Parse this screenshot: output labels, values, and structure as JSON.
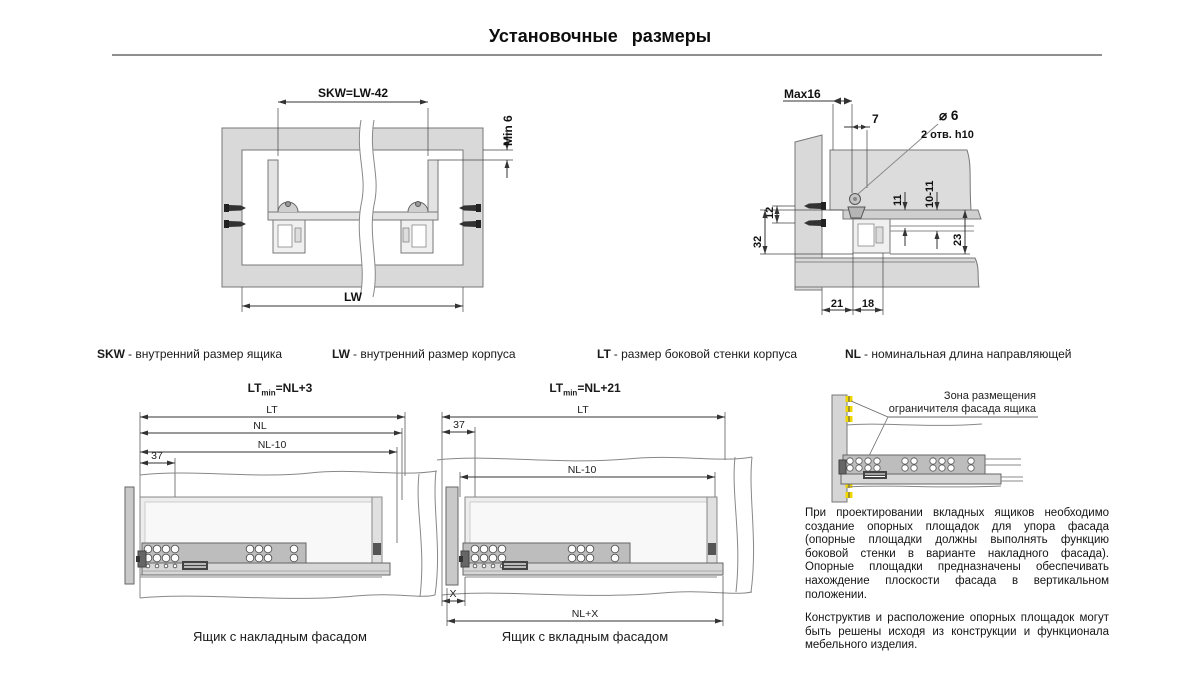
{
  "title": "Установочные размеры",
  "legend": [
    {
      "abbr": "SKW",
      "desc": "- внутренний размер ящика"
    },
    {
      "abbr": "LW",
      "desc": "- внутренний размер корпуса"
    },
    {
      "abbr": "LT",
      "desc": "- размер боковой стенки корпуса"
    },
    {
      "abbr": "NL",
      "desc": "- номинальная длина направляющей"
    }
  ],
  "top_left_drawing": {
    "skw": "SKW=LW-42",
    "min6": "Min 6",
    "lw": "LW"
  },
  "top_right_drawing": {
    "max16": "Max16",
    "seven": "7",
    "diameter": "⌀ 6",
    "holes": "2 отв. h10",
    "d12": "12",
    "d32": "32",
    "d11": "11",
    "d10_11": "10-11",
    "d23": "23",
    "d21": "21",
    "d18": "18"
  },
  "bottom_left_drawing": {
    "formula_base": "LT",
    "formula_sub": "min",
    "formula_rest": "=NL+3",
    "lt": "LT",
    "nl": "NL",
    "nl10": "NL-10",
    "d37": "37",
    "caption": "Ящик с накладным фасадом"
  },
  "bottom_middle_drawing": {
    "formula_base": "LT",
    "formula_sub": "min",
    "formula_rest": "=NL+21",
    "lt": "LT",
    "d37": "37",
    "nl10": "NL-10",
    "x": "X",
    "nlx": "NL+X",
    "caption": "Ящик с вкладным фасадом"
  },
  "bottom_right_drawing": {
    "zone_line1": "Зона размещения",
    "zone_line2": "ограничителя фасада ящика"
  },
  "notes": {
    "p1": "При проектировании вкладных ящиков необходимо создание опорных площадок для упора фасада (опорные площадки должны выполнять функцию боковой стенки в варианте накладного фасада). Опорные площадки предназначены обеспечивать нахождение плоскости фасада в вертикальном положении.",
    "p2": "Конструктив и расположение опорных площадок могут быть решены исходя из конструкции и функционала мебельного изделия."
  },
  "colors": {
    "panel_fill": "#d9d9d9",
    "rail_fill": "#bdbdbd",
    "accent_yellow": "#f0d800",
    "line": "#555555",
    "rule_gray": "#8f8f8f"
  }
}
